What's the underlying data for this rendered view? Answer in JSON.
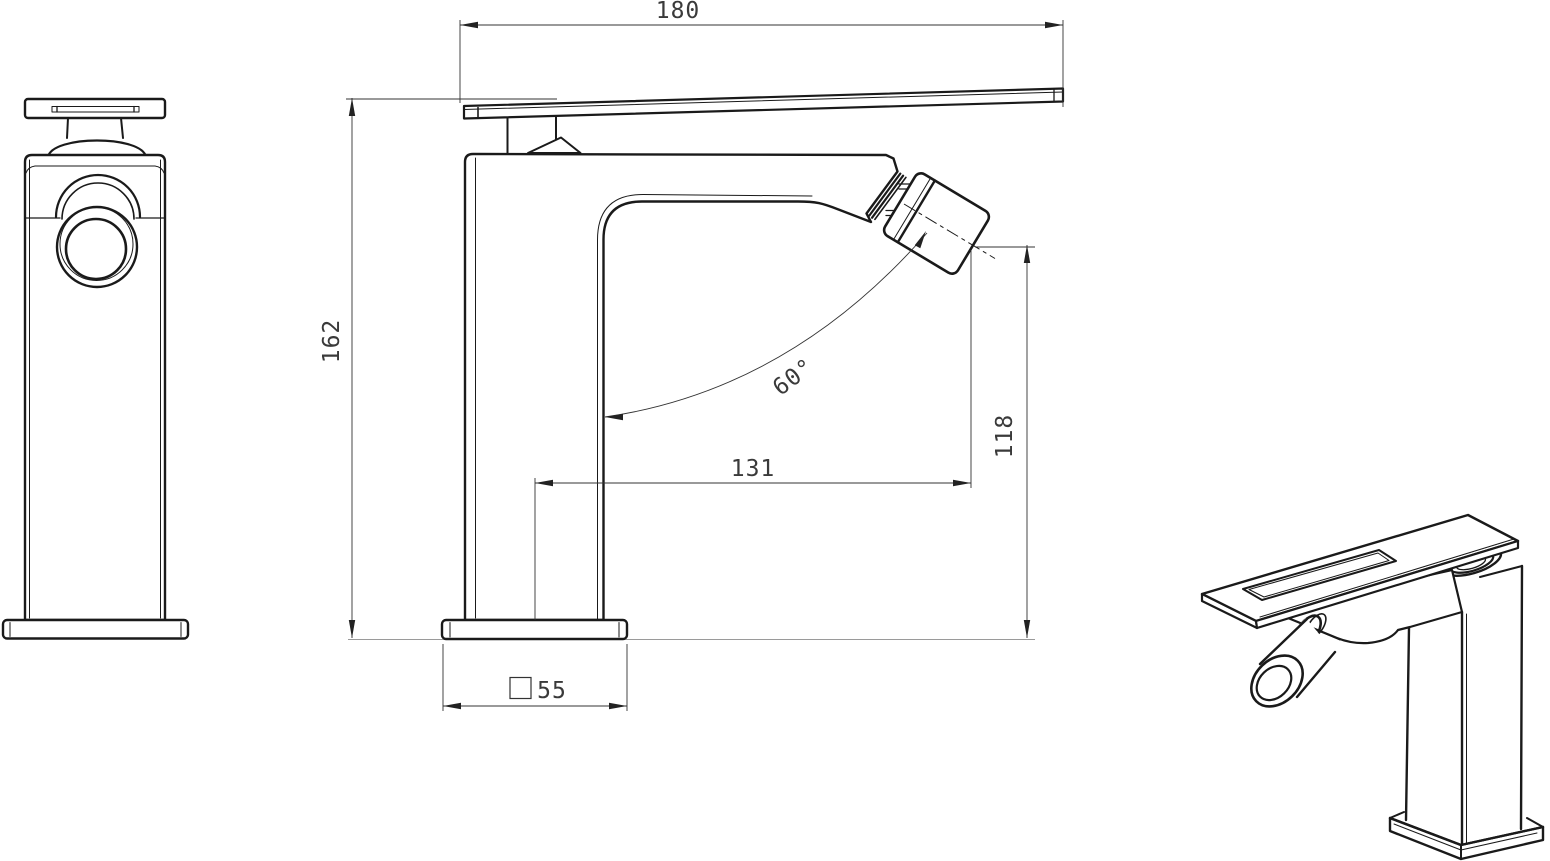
{
  "drawing": {
    "background_color": "#ffffff",
    "line_color": "#1a1a1a",
    "dimension_line_color": "#333333",
    "reference_line_color": "#9a9a9a",
    "text_color": "#3a3a3a"
  },
  "dimensions": {
    "handle_length": {
      "value": "180"
    },
    "overall_height": {
      "value": "162"
    },
    "spout_reach": {
      "value": "131"
    },
    "outlet_height": {
      "value": "118"
    },
    "outlet_angle": {
      "value": "60°"
    },
    "base_square_size": {
      "value": "55",
      "symbol": "square"
    }
  }
}
